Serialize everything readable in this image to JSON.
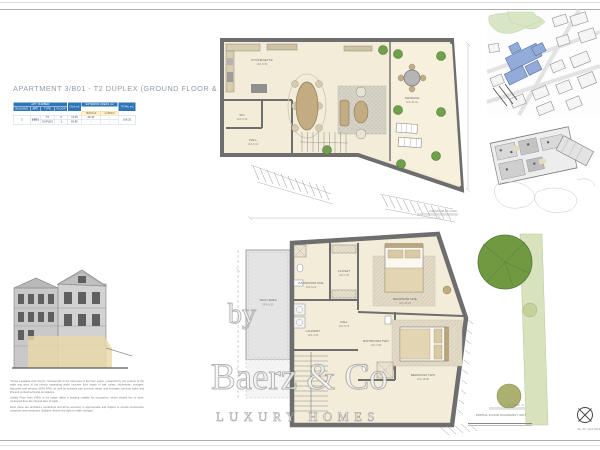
{
  "page": {
    "title": "APARTMENT 3/B01 - T2 DUPLEX (GROUND FLOOR & FLOOR -1)"
  },
  "table": {
    "group_headers": {
      "apt": "APT. NUMBER",
      "exterior": "EXTERIOR AREAS m2"
    },
    "columns": [
      "BUILDING",
      "APT.",
      "TYPE",
      "FLOOR",
      "GLA m2",
      "TERRACE",
      "GARDEN",
      "TOTAL m2"
    ],
    "rows": [
      [
        "3",
        "3/B01",
        "T2",
        "0",
        "74.05",
        "26.40",
        "-",
        "166.25"
      ],
      [
        "",
        "",
        "DUPLEX",
        "-1",
        "65.80",
        "-",
        "-",
        ""
      ]
    ]
  },
  "plans": {
    "ground": {
      "caption": "GROUND FLOOR",
      "rooms": [
        {
          "name": "KITCHENETTE",
          "area": "LFA 8.35"
        },
        {
          "name": "WC",
          "area": "LFA 2.40"
        },
        {
          "name": "HALL",
          "area": "LFA 6.10"
        },
        {
          "name": "TERRACE",
          "area": "LFA 26.40"
        }
      ]
    },
    "lower": {
      "caption": "FLOOR -1",
      "rooms": [
        {
          "name": "BATHROOM ONE",
          "area": "LFA 5.20"
        },
        {
          "name": "CLOSET",
          "area": "LFA 7.25"
        },
        {
          "name": "BEDROOM ONE",
          "area": "LFA 15.40"
        },
        {
          "name": "HALL",
          "area": "LFA 5.75"
        },
        {
          "name": "LAUNDRY",
          "area": "LFA 3.10"
        },
        {
          "name": "BATHROOM TWO",
          "area": "LFA 4.65"
        },
        {
          "name": "BEDROOM TWO",
          "area": "LFA 16.80"
        },
        {
          "name": "TECH AREA",
          "area": "GFA 9.35"
        }
      ]
    }
  },
  "disclaimer": {
    "p1": "*Gross Leasable Area (GLA): corresponds to the total area of the floor space, measured by the exterior of the walls and axes of the interior separating walls; includes floor space of hall, toilets, kitchenette, storages, balconies and terraces (50% AFA), as well as entrance pax common areas, and excludes common stairs and lifts and vertical technical circulations.",
    "p2": "Usable Floor Area (UFA) is the space within a building suitable for occupation, where people live or work, measured from the internal face of walls.",
    "p3": "Floor plans are architect's renderings and all its accuracy is approximate and subject to overall construction variances and tolerances. Builders reserve the right to make changes."
  },
  "watermark": {
    "by": "by",
    "brand": "Baerz & Co",
    "tagline": "LUXURY HOMES"
  },
  "footer": {
    "occupancy_note": "PARTIAL FLOOR OCCUPANCY UNIT",
    "version": "Ver. 00 - April 2024"
  },
  "colors": {
    "table_header_blue": "#2e75b6",
    "wall_gray": "#6e6e6e",
    "plan_cream": "#f2ecd9",
    "furniture_tan": "#c3ab82",
    "plant_green": "#6fa04c",
    "map_highlight_blue": "#92abd8",
    "park_green": "#d8e6c6",
    "elevation_highlight": "#e9d9a6"
  }
}
